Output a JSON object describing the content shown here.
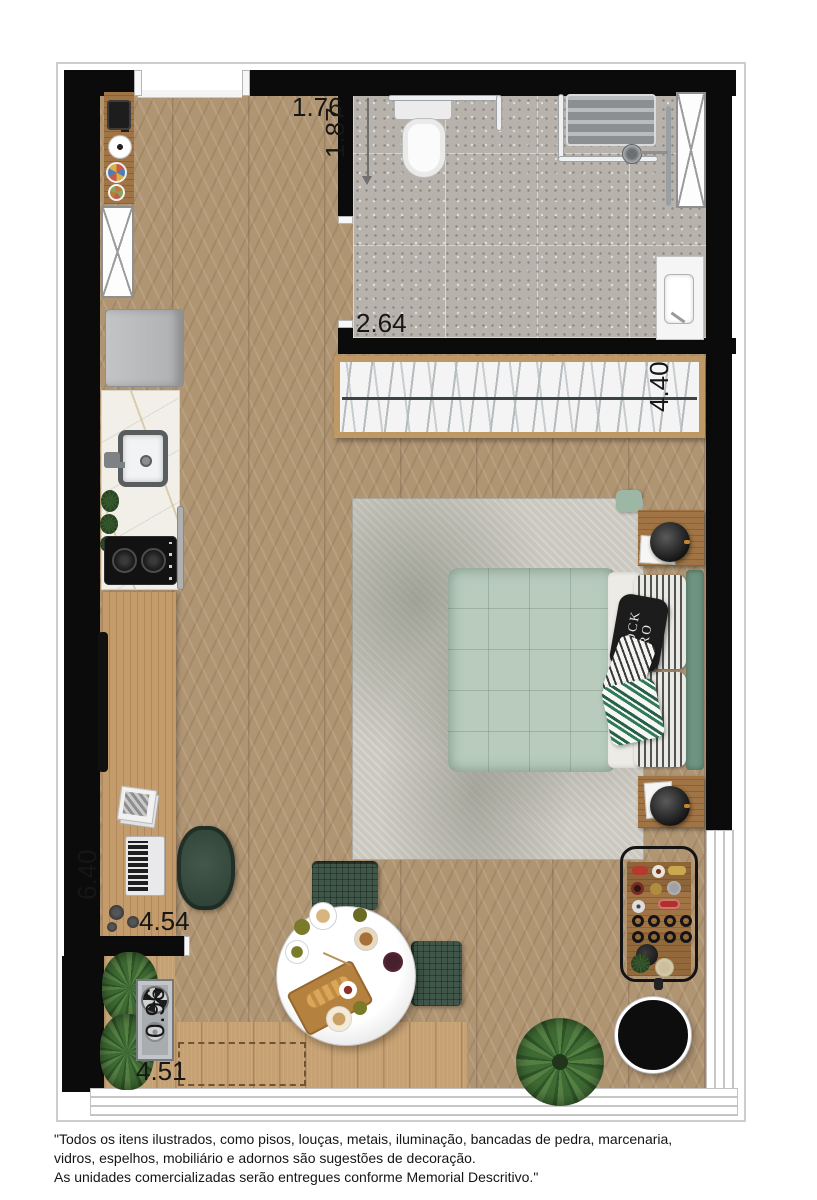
{
  "dims": {
    "entry": "1.76",
    "bath_depth": "1.87",
    "bath_width": "2.64",
    "closet_width": "4.40",
    "unit_depth": "6.40",
    "living_width": "4.54",
    "terrace_depth": "0.96",
    "terrace_width": "4.51"
  },
  "pillow": {
    "line1": "ROCK",
    "line2": "RO"
  },
  "disclaimer": {
    "line1": "\"Todos os itens ilustrados, como pisos, louças, metais, iluminação, bancadas de pedra, marcenaria,",
    "line2": "vidros, espelhos, mobiliário e adornos são sugestões de decoração.",
    "line3": "As unidades comercializadas serão entregues conforme Memorial Descritivo.\""
  },
  "colors": {
    "wall": "#0b0b0b",
    "floor_wood": "#b09573",
    "deck_wood": "#c6a173",
    "terrazzo": "#b7b3ac",
    "marble": "#f2efe9",
    "bed": "#b8cbbd",
    "headboard": "#6d9480",
    "greenery": "#3e6a33",
    "accent_black": "#141414"
  }
}
